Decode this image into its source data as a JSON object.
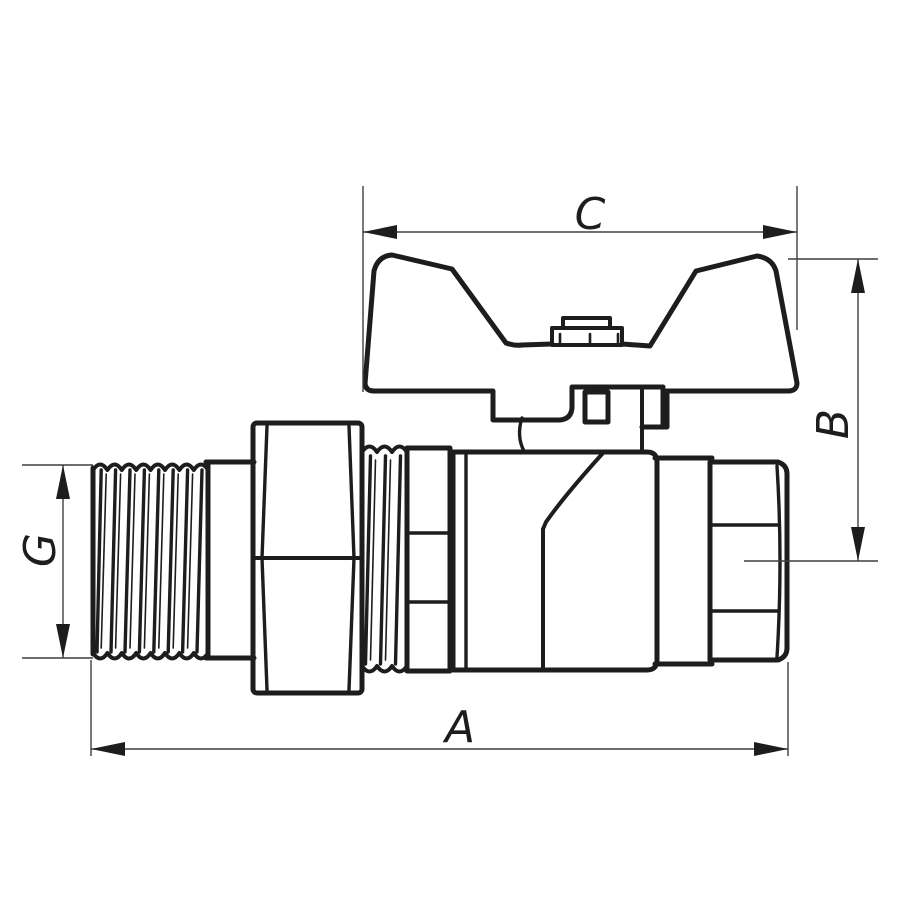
{
  "figure": {
    "dimension_labels": {
      "overall_length": "A",
      "handle_height": "B",
      "handle_width": "C",
      "thread_size": "G"
    }
  },
  "colors": {
    "outline": "#1d1d1b",
    "dimension_line": "#3f3f3f",
    "background": "#ffffff"
  }
}
